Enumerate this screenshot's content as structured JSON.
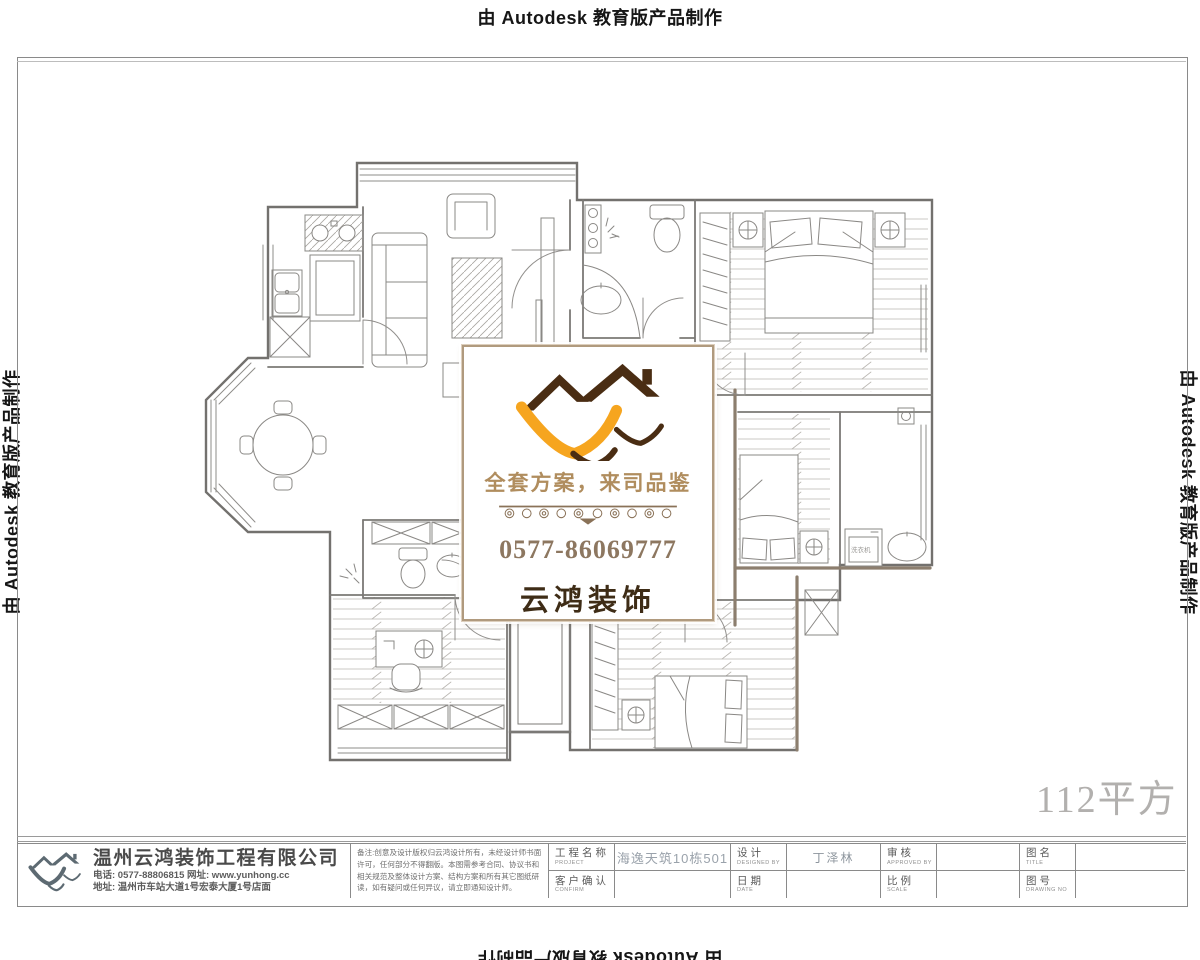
{
  "edu_banner": {
    "text": "由 Autodesk 教育版产品制作"
  },
  "area_label": "112平方",
  "watermark_card": {
    "tagline": "全套方案，来司品鉴",
    "phone": "0577-86069777",
    "brand": "云鸿装饰",
    "colors": {
      "roof": "#4a2d13",
      "swoosh": "#f6a51f",
      "tagline": "#b08d5e",
      "phone": "#8d7760",
      "brand": "#3e2c16",
      "border": "#b09a7e"
    }
  },
  "title_block": {
    "company": {
      "name": "温州云鸿装饰工程有限公司",
      "phone_line": "电话: 0577-88806815 网址: www.yunhong.cc",
      "address_line": "地址: 温州市车站大道1号宏泰大厦1号店面"
    },
    "remarks": "备注:创意及设计版权归云鸿设计所有，未经设计师书面许可，任何部分不得翻版。本图需参考合同、协议书和相关规范及整体设计方案、结构方案和所有其它图纸研读，如有疑问或任何异议，请立即通知设计师。",
    "fields": {
      "project": {
        "label": "工程名称",
        "sub": "PROJECT",
        "value": "海逸天筑10栋501"
      },
      "confirm": {
        "label": "客户确认",
        "sub": "CONFIRM",
        "value": ""
      },
      "design": {
        "label": "设计",
        "sub": "DESIGNED BY",
        "value": "丁泽林"
      },
      "date": {
        "label": "日期",
        "sub": "DATE",
        "value": ""
      },
      "review": {
        "label": "审核",
        "sub": "APPROVED BY",
        "value": ""
      },
      "scale": {
        "label": "比例",
        "sub": "SCALE",
        "value": ""
      },
      "title": {
        "label": "图名",
        "sub": "TITLE",
        "value": ""
      },
      "number": {
        "label": "图号",
        "sub": "DRAWING NO",
        "value": ""
      }
    }
  },
  "floor_plan": {
    "washer_label": "洗衣机"
  }
}
